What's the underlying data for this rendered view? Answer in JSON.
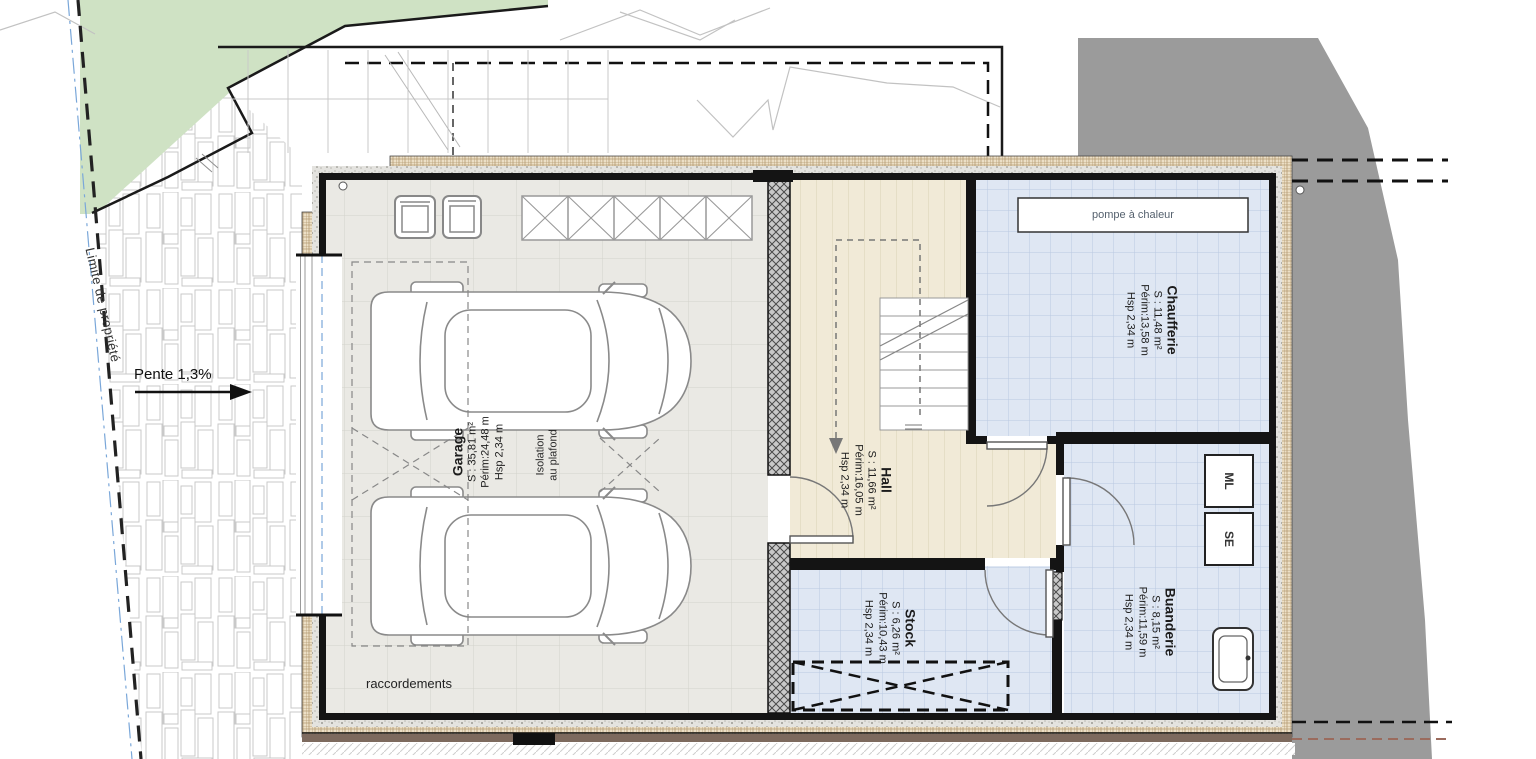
{
  "site": {
    "property_line_label": "Limite de propriété",
    "slope_label": "Pente 1,3%",
    "connections_label": "raccordements"
  },
  "rooms": {
    "garage": {
      "name": "Garage",
      "area": "S : 35,81 m²",
      "perimeter": "Périm:24,48 m",
      "ceiling": "Hsp 2,34 m",
      "note": "Isolation\nau plafond"
    },
    "hall": {
      "name": "Hall",
      "area": "S : 11,66 m²",
      "perimeter": "Périm:16,05 m",
      "ceiling": "Hsp 2,34 m"
    },
    "chaufferie": {
      "name": "Chaufferie",
      "area": "S : 11,48 m²",
      "perimeter": "Périm:13,58 m",
      "ceiling": "Hsp 2,34 m"
    },
    "stock": {
      "name": "Stock",
      "area": "S : 6,26 m²",
      "perimeter": "Périm:10,43 m",
      "ceiling": "Hsp 2,34 m"
    },
    "buanderie": {
      "name": "Buanderie",
      "area": "S : 8,15 m²",
      "perimeter": "Périm:11,59 m",
      "ceiling": "Hsp 2,34 m"
    }
  },
  "equipment": {
    "heat_pump_label": "pompe à chaleur",
    "washing_machine_label": "ML",
    "dryer_label": "SE"
  },
  "colors": {
    "lawn_green": "#cfe2c4",
    "terrain_gray": "#9b9b9b",
    "garage_floor": "#eae9e4",
    "hall_floor": "#f1ead7",
    "wet_room_blue": "#dfe7f3",
    "insulation_beige": "#ecdfc6",
    "foundation_brown": "#7d6a5e",
    "wall_black": "#141414",
    "property_line_blue": "#7aa7d9"
  }
}
